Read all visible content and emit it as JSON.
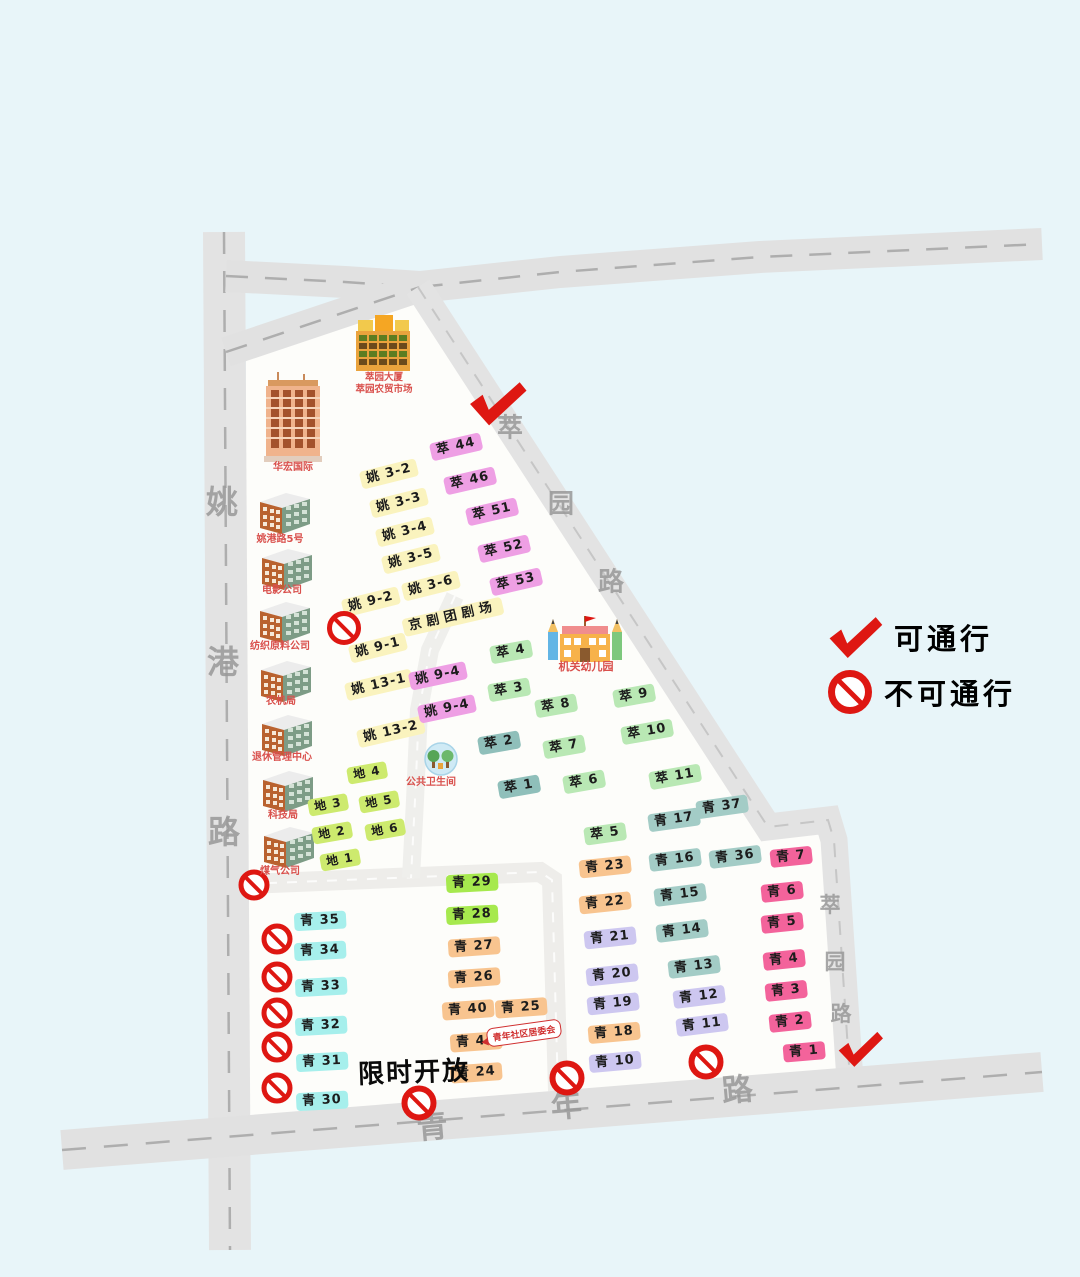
{
  "legend": {
    "pass_label": "可通行",
    "no_pass_label": "不可通行"
  },
  "notes": {
    "limited_open": "限时开放",
    "committee_bubble": "青年社区居委会"
  },
  "roads": {
    "yaogang": {
      "name": "姚港路"
    },
    "qingnian": {
      "name": "青年路"
    },
    "cuiyuan": {
      "name": "萃园路"
    }
  },
  "road_label_chars": [
    {
      "ch": "姚",
      "x": 222,
      "y": 500,
      "fs": 32,
      "rot": 0
    },
    {
      "ch": "港",
      "x": 223,
      "y": 660,
      "fs": 32,
      "rot": 0
    },
    {
      "ch": "路",
      "x": 224,
      "y": 830,
      "fs": 32,
      "rot": 0
    },
    {
      "ch": "萃",
      "x": 510,
      "y": 426,
      "fs": 26,
      "rot": 0
    },
    {
      "ch": "园",
      "x": 561,
      "y": 502,
      "fs": 26,
      "rot": 0
    },
    {
      "ch": "路",
      "x": 611,
      "y": 580,
      "fs": 26,
      "rot": 0
    },
    {
      "ch": "萃",
      "x": 830,
      "y": 904,
      "fs": 21,
      "rot": 0
    },
    {
      "ch": "园",
      "x": 835,
      "y": 961,
      "fs": 21,
      "rot": 0
    },
    {
      "ch": "路",
      "x": 841,
      "y": 1013,
      "fs": 21,
      "rot": 0
    },
    {
      "ch": "青",
      "x": 432,
      "y": 1124,
      "fs": 31,
      "rot": -5
    },
    {
      "ch": "年",
      "x": 566,
      "y": 1103,
      "fs": 31,
      "rot": -5
    },
    {
      "ch": "路",
      "x": 737,
      "y": 1087,
      "fs": 31,
      "rot": -5
    }
  ],
  "landmarks": {
    "market": {
      "label1": "萃园大厦",
      "label2": "萃园农贸市场"
    },
    "huahong": {
      "label": "华宏国际"
    },
    "yaogang5": {
      "label": "姚港路5号"
    },
    "film": {
      "label": "电影公司"
    },
    "textile": {
      "label": "纺织原料公司"
    },
    "agrimachine": {
      "label": "农机局"
    },
    "retire": {
      "label": "退休管理中心"
    },
    "scitech": {
      "label": "科技局"
    },
    "gas": {
      "label": "煤气公司"
    },
    "kindergarten": {
      "label": "机关幼儿园"
    },
    "toilet": {
      "label": "公共卫生间"
    }
  },
  "buildings": [
    {
      "label": "姚 3-2",
      "g": "yao",
      "x": 389,
      "y": 474,
      "rot": -14
    },
    {
      "label": "姚 3-3",
      "g": "yao",
      "x": 399,
      "y": 503,
      "rot": -14
    },
    {
      "label": "姚 3-4",
      "g": "yao",
      "x": 405,
      "y": 532,
      "rot": -14
    },
    {
      "label": "姚 3-5",
      "g": "yao",
      "x": 411,
      "y": 559,
      "rot": -14
    },
    {
      "label": "姚 3-6",
      "g": "yao",
      "x": 431,
      "y": 586,
      "rot": -14
    },
    {
      "label": "姚 9-2",
      "g": "yao",
      "x": 371,
      "y": 602,
      "rot": -14
    },
    {
      "label": "姚 9-1",
      "g": "yao",
      "x": 378,
      "y": 648,
      "rot": -14
    },
    {
      "label": "姚 13-1",
      "g": "yao",
      "x": 379,
      "y": 685,
      "rot": -13
    },
    {
      "label": "姚 13-2",
      "g": "yao",
      "x": 391,
      "y": 732,
      "rot": -13
    },
    {
      "label": "京剧团剧场",
      "g": "theater",
      "x": 453,
      "y": 617,
      "rot": -13
    },
    {
      "label": "萃 44",
      "g": "pink",
      "x": 456,
      "y": 447,
      "rot": -13
    },
    {
      "label": "萃 46",
      "g": "pink",
      "x": 470,
      "y": 481,
      "rot": -13
    },
    {
      "label": "萃 51",
      "g": "pink",
      "x": 492,
      "y": 512,
      "rot": -13
    },
    {
      "label": "萃 52",
      "g": "pink",
      "x": 504,
      "y": 549,
      "rot": -13
    },
    {
      "label": "萃 53",
      "g": "pink",
      "x": 516,
      "y": 582,
      "rot": -13
    },
    {
      "label": "姚 9-4",
      "g": "pink",
      "x": 438,
      "y": 676,
      "rot": -12
    },
    {
      "label": "姚 9-4",
      "g": "pink",
      "x": 447,
      "y": 709,
      "rot": -12
    },
    {
      "label": "萃 4",
      "g": "green",
      "x": 511,
      "y": 652,
      "rot": -10
    },
    {
      "label": "萃 3",
      "g": "green",
      "x": 509,
      "y": 690,
      "rot": -10
    },
    {
      "label": "萃 8",
      "g": "green",
      "x": 556,
      "y": 706,
      "rot": -10
    },
    {
      "label": "萃 9",
      "g": "green",
      "x": 634,
      "y": 696,
      "rot": -10
    },
    {
      "label": "萃 7",
      "g": "green",
      "x": 564,
      "y": 747,
      "rot": -10
    },
    {
      "label": "萃 10",
      "g": "green",
      "x": 647,
      "y": 732,
      "rot": -10
    },
    {
      "label": "萃 6",
      "g": "green",
      "x": 584,
      "y": 782,
      "rot": -10
    },
    {
      "label": "萃 11",
      "g": "green",
      "x": 675,
      "y": 777,
      "rot": -10
    },
    {
      "label": "萃 5",
      "g": "green",
      "x": 605,
      "y": 834,
      "rot": -8
    },
    {
      "label": "萃 2",
      "g": "teal",
      "x": 499,
      "y": 743,
      "rot": -10
    },
    {
      "label": "萃 1",
      "g": "teal",
      "x": 519,
      "y": 787,
      "rot": -10
    },
    {
      "label": "地 4",
      "g": "di",
      "x": 367,
      "y": 773,
      "rot": -10
    },
    {
      "label": "地 5",
      "g": "di",
      "x": 379,
      "y": 802,
      "rot": -10
    },
    {
      "label": "地 3",
      "g": "di",
      "x": 328,
      "y": 805,
      "rot": -10
    },
    {
      "label": "地 2",
      "g": "di",
      "x": 332,
      "y": 833,
      "rot": -10
    },
    {
      "label": "地 6",
      "g": "di",
      "x": 385,
      "y": 830,
      "rot": -10
    },
    {
      "label": "地 1",
      "g": "di",
      "x": 340,
      "y": 860,
      "rot": -10
    },
    {
      "label": "青 17",
      "g": "qteal",
      "x": 674,
      "y": 820,
      "rot": -8
    },
    {
      "label": "青 37",
      "g": "qteal",
      "x": 722,
      "y": 807,
      "rot": -8
    },
    {
      "label": "青 16",
      "g": "qteal",
      "x": 675,
      "y": 860,
      "rot": -7
    },
    {
      "label": "青 36",
      "g": "qteal",
      "x": 735,
      "y": 857,
      "rot": -7
    },
    {
      "label": "青 15",
      "g": "qteal",
      "x": 680,
      "y": 895,
      "rot": -7
    },
    {
      "label": "青 14",
      "g": "qteal",
      "x": 682,
      "y": 931,
      "rot": -7
    },
    {
      "label": "青 13",
      "g": "qteal",
      "x": 694,
      "y": 967,
      "rot": -7
    },
    {
      "label": "青 23",
      "g": "qorange",
      "x": 605,
      "y": 867,
      "rot": -6
    },
    {
      "label": "青 22",
      "g": "qorange",
      "x": 605,
      "y": 903,
      "rot": -6
    },
    {
      "label": "青 21",
      "g": "qlav",
      "x": 610,
      "y": 938,
      "rot": -6
    },
    {
      "label": "青 20",
      "g": "qlav",
      "x": 612,
      "y": 975,
      "rot": -6
    },
    {
      "label": "青 19",
      "g": "qlav",
      "x": 613,
      "y": 1004,
      "rot": -6
    },
    {
      "label": "青 18",
      "g": "qorange",
      "x": 614,
      "y": 1033,
      "rot": -5
    },
    {
      "label": "青 10",
      "g": "qlav",
      "x": 615,
      "y": 1062,
      "rot": -5
    },
    {
      "label": "青 12",
      "g": "qlav",
      "x": 699,
      "y": 997,
      "rot": -7
    },
    {
      "label": "青 11",
      "g": "qlav",
      "x": 702,
      "y": 1025,
      "rot": -7
    },
    {
      "label": "青 29",
      "g": "qgreen",
      "x": 472,
      "y": 883,
      "rot": -3
    },
    {
      "label": "青 28",
      "g": "qgreen",
      "x": 472,
      "y": 915,
      "rot": -3
    },
    {
      "label": "青 27",
      "g": "qorange",
      "x": 474,
      "y": 947,
      "rot": -4
    },
    {
      "label": "青 26",
      "g": "qorange",
      "x": 474,
      "y": 978,
      "rot": -4
    },
    {
      "label": "青 40",
      "g": "qorange",
      "x": 468,
      "y": 1010,
      "rot": -4
    },
    {
      "label": "青 25",
      "g": "qorange",
      "x": 521,
      "y": 1008,
      "rot": -4
    },
    {
      "label": "青 41",
      "g": "qorange",
      "x": 476,
      "y": 1042,
      "rot": -4
    },
    {
      "label": "青 24",
      "g": "qorange",
      "x": 476,
      "y": 1073,
      "rot": -4
    },
    {
      "label": "青 7",
      "g": "qpink",
      "x": 791,
      "y": 857,
      "rot": -6
    },
    {
      "label": "青 6",
      "g": "qpink",
      "x": 782,
      "y": 892,
      "rot": -6
    },
    {
      "label": "青 5",
      "g": "qpink",
      "x": 782,
      "y": 923,
      "rot": -6
    },
    {
      "label": "青 4",
      "g": "qpink",
      "x": 784,
      "y": 960,
      "rot": -6
    },
    {
      "label": "青 3",
      "g": "qpink",
      "x": 786,
      "y": 991,
      "rot": -6
    },
    {
      "label": "青 2",
      "g": "qpink",
      "x": 790,
      "y": 1022,
      "rot": -6
    },
    {
      "label": "青 1",
      "g": "qpink",
      "x": 804,
      "y": 1052,
      "rot": -5
    },
    {
      "label": "青 35",
      "g": "qcyan",
      "x": 320,
      "y": 921,
      "rot": -3
    },
    {
      "label": "青 34",
      "g": "qcyan",
      "x": 320,
      "y": 951,
      "rot": -3
    },
    {
      "label": "青 33",
      "g": "qcyan",
      "x": 321,
      "y": 987,
      "rot": -3
    },
    {
      "label": "青 32",
      "g": "qcyan",
      "x": 321,
      "y": 1026,
      "rot": -3
    },
    {
      "label": "青 31",
      "g": "qcyan",
      "x": 322,
      "y": 1062,
      "rot": -3
    },
    {
      "label": "青 30",
      "g": "qcyan",
      "x": 322,
      "y": 1101,
      "rot": -3
    }
  ],
  "markers": {
    "no_entry": [
      {
        "x": 344,
        "y": 628,
        "d": 34
      },
      {
        "x": 254,
        "y": 885,
        "d": 31
      },
      {
        "x": 277,
        "y": 939,
        "d": 31
      },
      {
        "x": 277,
        "y": 977,
        "d": 31
      },
      {
        "x": 277,
        "y": 1013,
        "d": 31
      },
      {
        "x": 277,
        "y": 1047,
        "d": 31
      },
      {
        "x": 277,
        "y": 1088,
        "d": 31
      },
      {
        "x": 419,
        "y": 1103,
        "d": 35
      },
      {
        "x": 567,
        "y": 1078,
        "d": 35
      },
      {
        "x": 706,
        "y": 1062,
        "d": 35
      }
    ],
    "pass": [
      {
        "x": 497,
        "y": 405,
        "w": 58,
        "rot": 6
      },
      {
        "x": 860,
        "y": 1051,
        "w": 46,
        "rot": 4
      }
    ]
  },
  "colors": {
    "accent_red": "#de1712",
    "road_gray": "#e3e3e3",
    "estate_white": "#fdfdfa",
    "background": "#e8f5f9"
  }
}
